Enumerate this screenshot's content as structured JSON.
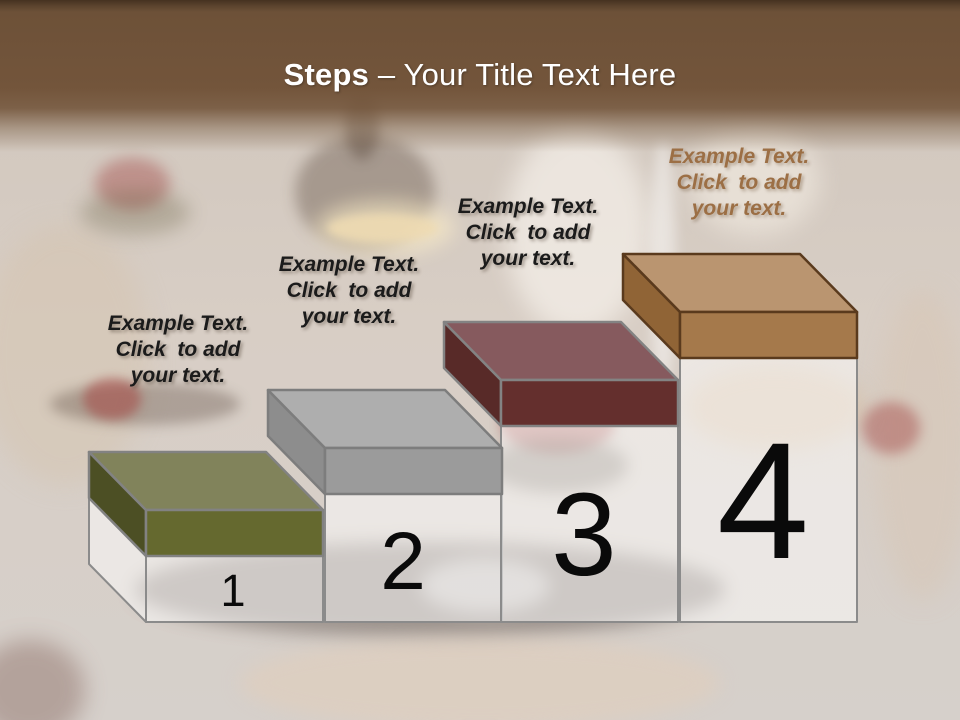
{
  "title": {
    "bold": "Steps",
    "rest": " – Your Title Text Here"
  },
  "header_colors": {
    "band_top": "#453220",
    "band_main": "#73553b",
    "title_text": "#ffffff"
  },
  "steps": [
    {
      "number": "1",
      "label": "Example Text.\nClick  to add\nyour text.",
      "label_color": "#1b1b1b",
      "colors": {
        "top": "#81835b",
        "front": "#65692f",
        "side": "#4c4f24",
        "stroke": "#828282"
      }
    },
    {
      "number": "2",
      "label": "Example Text.\nClick  to add\nyour text.",
      "label_color": "#1b1b1b",
      "colors": {
        "top": "#aeaeae",
        "front": "#9b9b9b",
        "side": "#8d8d8d",
        "stroke": "#7d7d7d"
      }
    },
    {
      "number": "3",
      "label": "Example Text.\nClick  to add\nyour text.",
      "label_color": "#1b1b1b",
      "colors": {
        "top": "#865a5e",
        "front": "#642f2d",
        "side": "#582a28",
        "stroke": "#838383"
      }
    },
    {
      "number": "4",
      "label": "Example Text.\nClick  to add\nyour text.",
      "label_color": "#9c6f45",
      "colors": {
        "top": "#ba9570",
        "front": "#a5794b",
        "side": "#906436",
        "stroke": "#5a3a1d"
      }
    }
  ],
  "pedestal": {
    "fill": "rgba(255,255,255,0.5)",
    "stroke": "#8b8b8b",
    "number_color": "#0a0a0a"
  }
}
